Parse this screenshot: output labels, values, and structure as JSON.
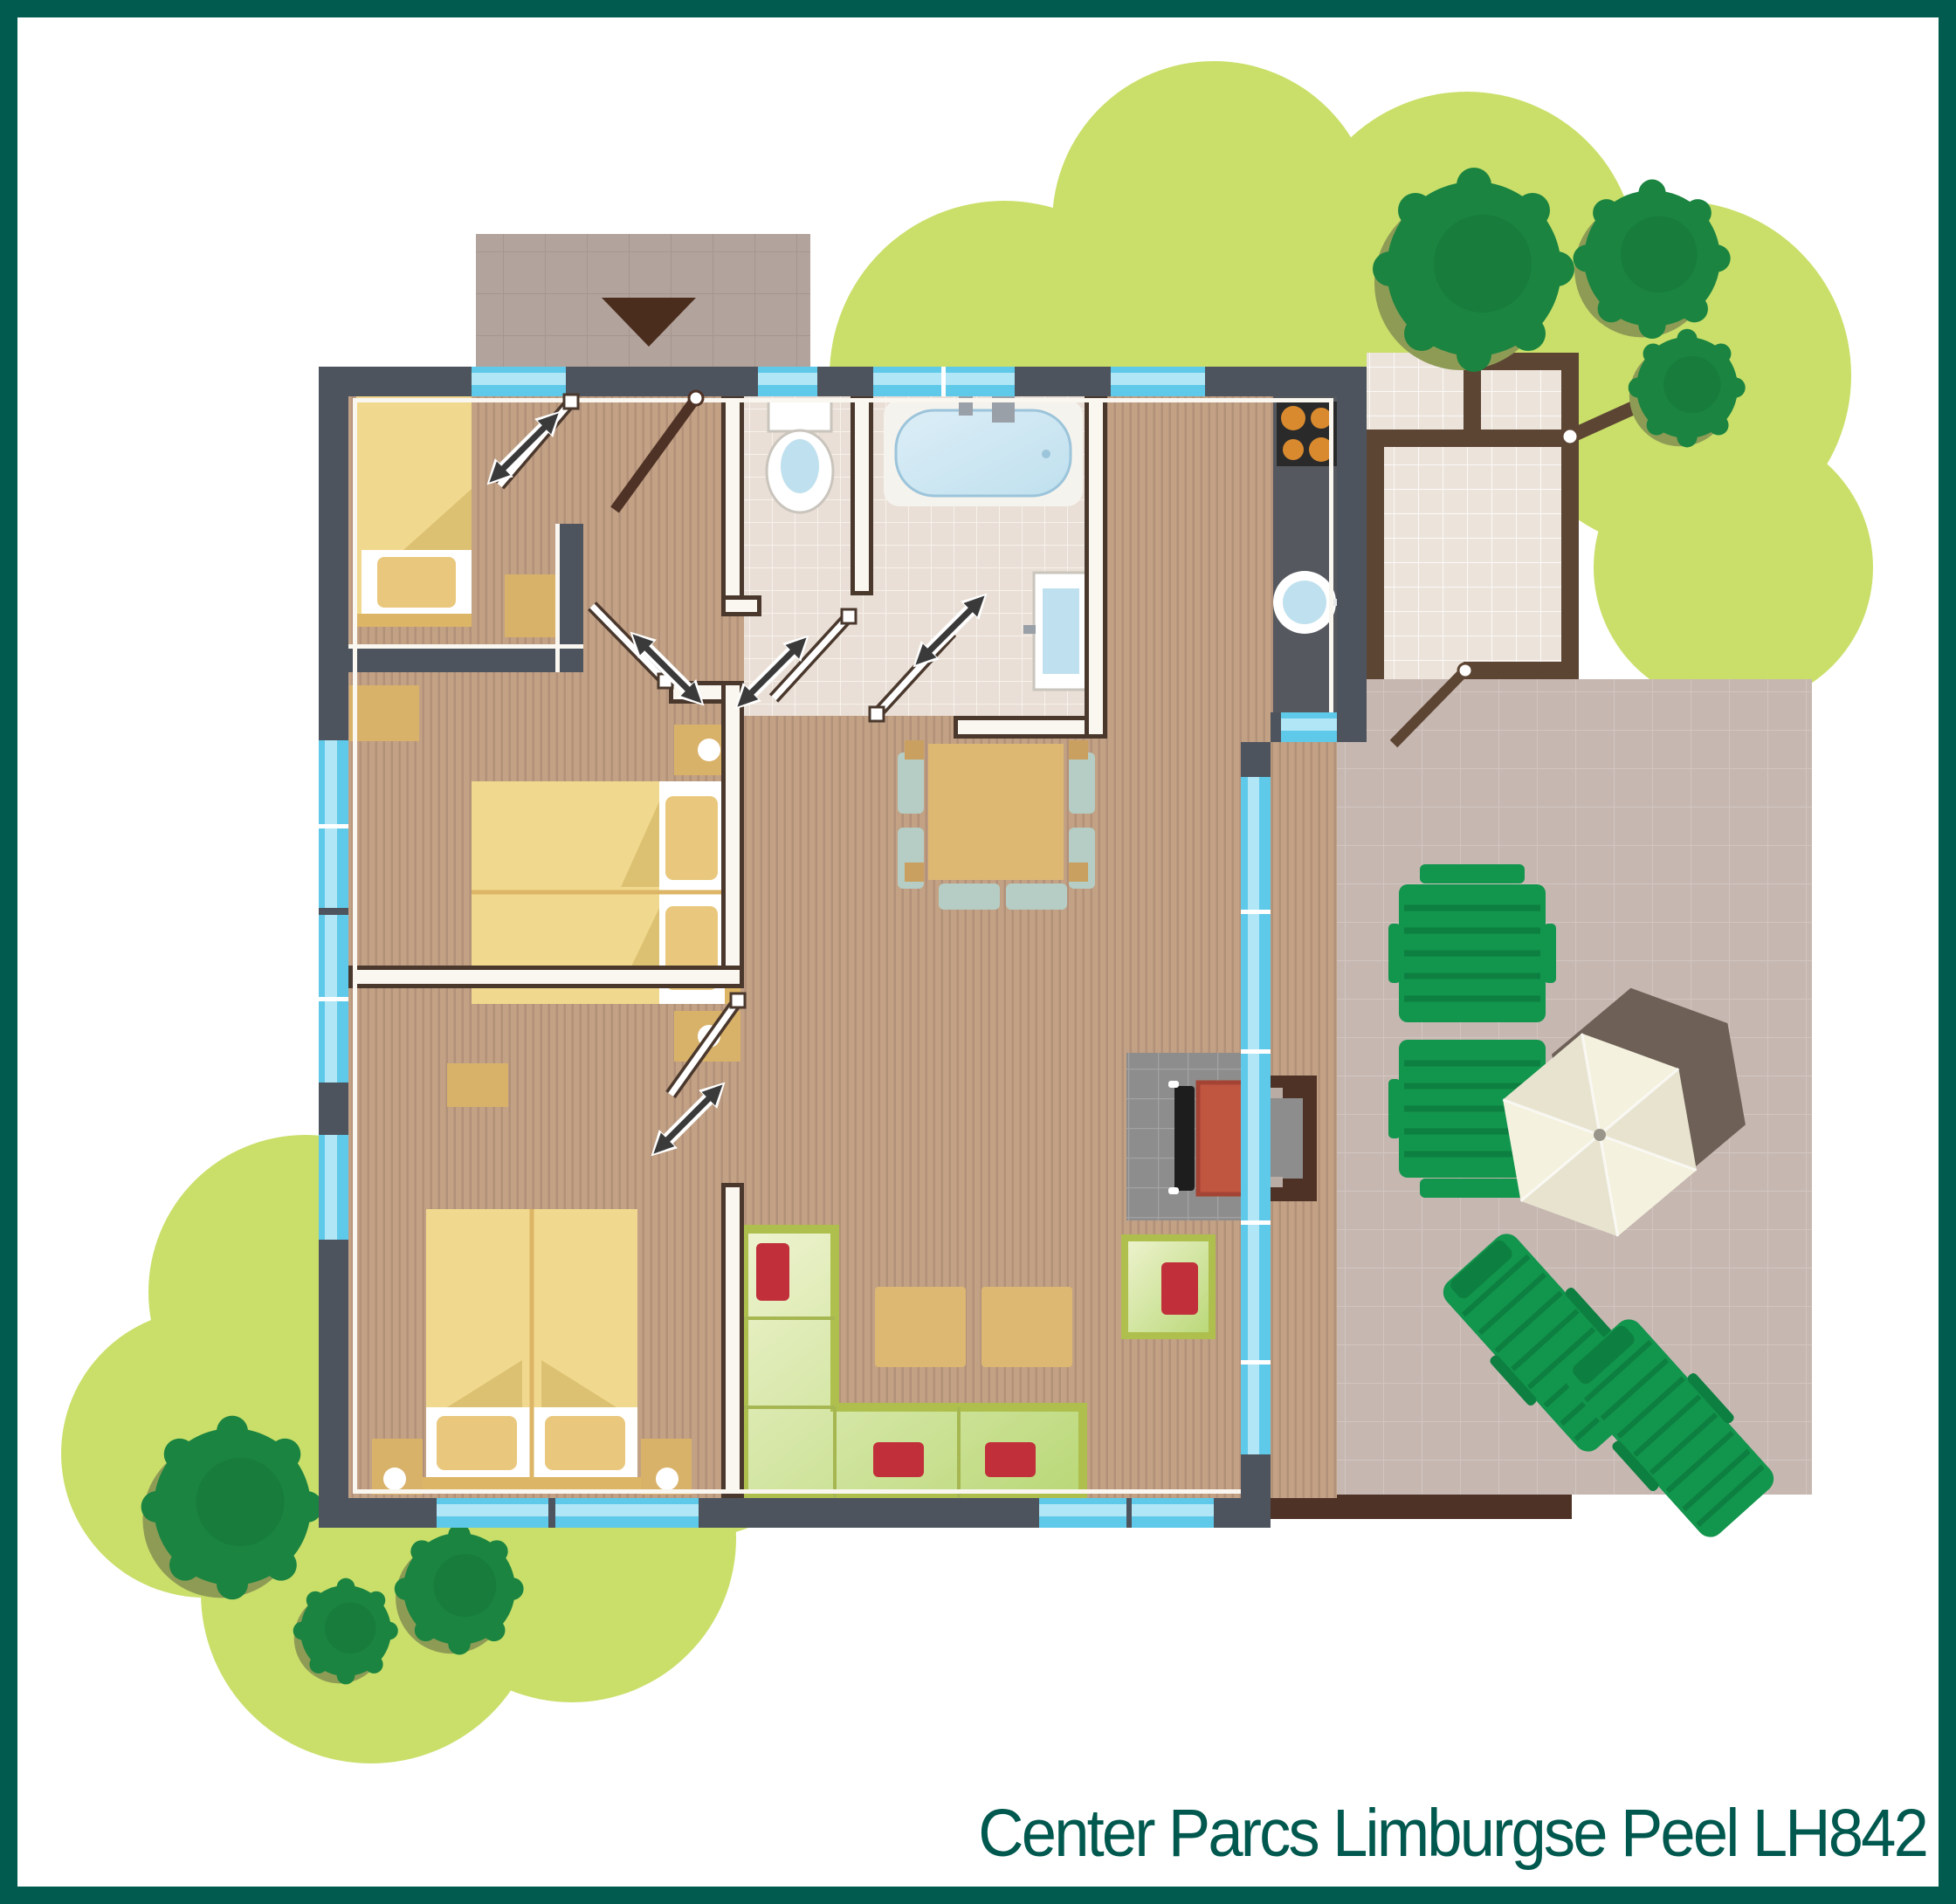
{
  "title": "Center Parcs Limburgse Peel LH842",
  "colors": {
    "frame": "#015b4e",
    "title": "#00584e",
    "blob": "#c9df6a",
    "tree": "#1a8440",
    "tree-dark": "#136c36",
    "tree-shadow": "#8e9b55",
    "wood": "#c2a184",
    "wood-stripe": "#b2917a",
    "tile": "#e9dfd6",
    "tile-line": "#f7f2ec",
    "terrace": "#c6b7b1",
    "terrace-line": "#d2c5bf",
    "shed-floor": "#ece3da",
    "wall-slate": "#4e545e",
    "wall-brown": "#4a382d",
    "wall-white": "#faf6f0",
    "shed-wall": "#5d4534",
    "window": "#5fc9e9",
    "window-light": "#b0e6f6",
    "porch": "#b2a39d",
    "porch-line": "#a5968f",
    "porch-tri": "#4b2d1d",
    "bed": "#f0d98e",
    "bed-fold": "#ddc172",
    "bed-head": "#dcb566",
    "pillow": "#e9c87d",
    "tan": "#d9b26a",
    "tan-dark": "#c9a05f",
    "table": "#ddb873",
    "chair": "#b5cdc4",
    "sofa-frame": "#aebf4e",
    "sofa-line": "#a6b751",
    "sofa-hi": "#eef3cf",
    "sofa-lo": "#b9d877",
    "red": "#c1303a",
    "counter": "#55585e",
    "stove": "#2a2a2a",
    "burner": "#d98a2e",
    "water": "#bfe0ee",
    "tub-rim": "#f5f3ee",
    "fixture-line": "#c9c4bc",
    "hearth": "#8d8d8d",
    "hearth-line": "#a3a3a3",
    "grate": "#1d1d1d",
    "firebox": "#c05540",
    "chimney": "#4f3226",
    "parasol": "#f4f1df",
    "parasol-dark": "#e7e3cf",
    "parasol-shadow": "#6e6057",
    "garden-green": "#12954c",
    "garden-green-dark": "#0d7f40",
    "arrow": "#3a3a3a"
  }
}
